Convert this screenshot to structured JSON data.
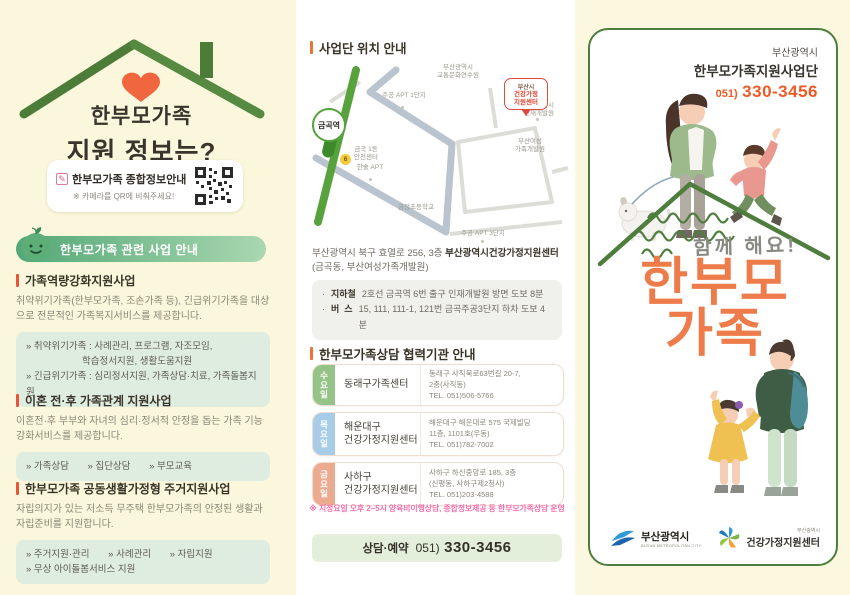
{
  "colors": {
    "accent_orange": "#ee5a26",
    "brand_green": "#4e7d3e",
    "badge_green": "#54a877",
    "title_orange": "#ee7c4a",
    "note_pink": "#f272ae",
    "day_wed": "#96c488",
    "day_thu": "#a7cce7",
    "day_fri": "#ecab90",
    "heart_orange": "#f0663f"
  },
  "left_panel": {
    "title_line1": "한부모가족",
    "title_line2": "지원 정보는?",
    "qr_card": {
      "title": "한부모가족 종합정보안내",
      "subtitle": "※ 카메라를 QR에 비춰주세요!"
    },
    "badge_label": "한부모가족 관련 사업 안내",
    "sections": [
      {
        "title": "가족역량강화지원사업",
        "body": "취약위기가족(한부모가족, 조손가족 등), 긴급위기가족을 대상으로 전문적인 가족복지서비스를 제공합니다.",
        "tag_line1": "» 취약위기가족 : 사례관리, 프로그램, 자조모임,",
        "tag_line2": "학습정서지원, 생활도움지원",
        "tag_line3": "» 긴급위기가족 : 심리정서지원, 가족상담·치료, 가족돌봄지원"
      },
      {
        "title": "이혼 전·후 가족관계 지원사업",
        "body": "이혼전·후 부부와 자녀의 심리·정서적 안정을 돕는 가족 기능 강화서비스를 제공합니다.",
        "tags": [
          "» 가족상담",
          "» 집단상담",
          "» 부모교육"
        ]
      },
      {
        "title": "한부모가족 공동생활가정형 주거지원사업",
        "body": "자립의지가 있는 저소득 무주택 한부모가족의 안정된 생활과 자립준비를 지원합니다.",
        "tags_row1": [
          "» 주거지원·관리",
          "» 사례관리",
          "» 자립지원"
        ],
        "tags_row2": "» 무상 아이돌봄서비스 지원"
      }
    ]
  },
  "middle_panel": {
    "location_header": "사업단 위치 안내",
    "map": {
      "station": "금곡역",
      "exit_number": "6",
      "label_traffic": "부산광역시\n교통문화연수원",
      "label_hrd": "부산광역시\n인재개발원",
      "label_apt1": "주공 APT 1단지",
      "label_women": "부산여성\n가족개발원",
      "label_hansol": "한솔 APT",
      "label_school": "금정초등학교",
      "label_apt3": "주공 APT 3단지",
      "label_dong": "금곡 1동\n안전센터",
      "pin_line1": "부산시",
      "pin_line2": "건강가정",
      "pin_line3": "지원센터"
    },
    "address_plain": "부산광역시 북구 효열로 256, 3층 ",
    "address_bold": "부산광역시건강가정지원센터",
    "address_line2": "(금곡동, 부산여성가족개발원)",
    "transit": [
      {
        "bullet": "·",
        "mode": "지하철",
        "desc": "2호선 금곡역 6번 출구 인재개발원 방면 도보 8분"
      },
      {
        "bullet": "·",
        "mode": "버  스",
        "desc": "15, 111, 111-1, 121번 금곡주공3단지 하차 도보 4분"
      }
    ],
    "partner_header": "한부모가족상담 협력기관 안내",
    "partners": [
      {
        "day": "수요일",
        "name_line1": "동래구가족센터",
        "name_line2": "",
        "addr_line1": "동래구 사직북로63번길 20-7,",
        "addr_line2": "2층(사직동)",
        "tel": "TEL. 051)506-5766"
      },
      {
        "day": "목요일",
        "name_line1": "해운대구",
        "name_line2": "건강가정지원센터",
        "addr_line1": "해운대구 해운대로 575 국제빌딩",
        "addr_line2": "11층, 1101호(우동)",
        "tel": "TEL. 051)782-7002"
      },
      {
        "day": "금요일",
        "name_line1": "사하구",
        "name_line2": "건강가정지원센터",
        "addr_line1": "사하구 하신중앙로 185, 3층",
        "addr_line2": "(신평동, 사하구제2청사)",
        "tel": "TEL. 051)203-4588"
      }
    ],
    "note": "※ 지정요일 오후 2~5시 양육비이행상담, 종합정보제공 등 한부모가족상담 운영",
    "footer": {
      "label": "상담·예약",
      "phone_prefix": "051)",
      "phone_number": "330-3456"
    }
  },
  "right_panel": {
    "org_region": "부산광역시",
    "org_name": "한부모가족지원사업단",
    "phone_prefix": "051)",
    "phone_number": "330-3456",
    "slogan": "함께 해요!",
    "title_line1": "한부모",
    "title_line2": "가족",
    "logo_busan": {
      "name": "부산광역시",
      "sub": "BUSAN METROPOLITAN CITY"
    },
    "logo_center": {
      "region": "부산광역시",
      "name": "건강가정지원센터"
    }
  }
}
